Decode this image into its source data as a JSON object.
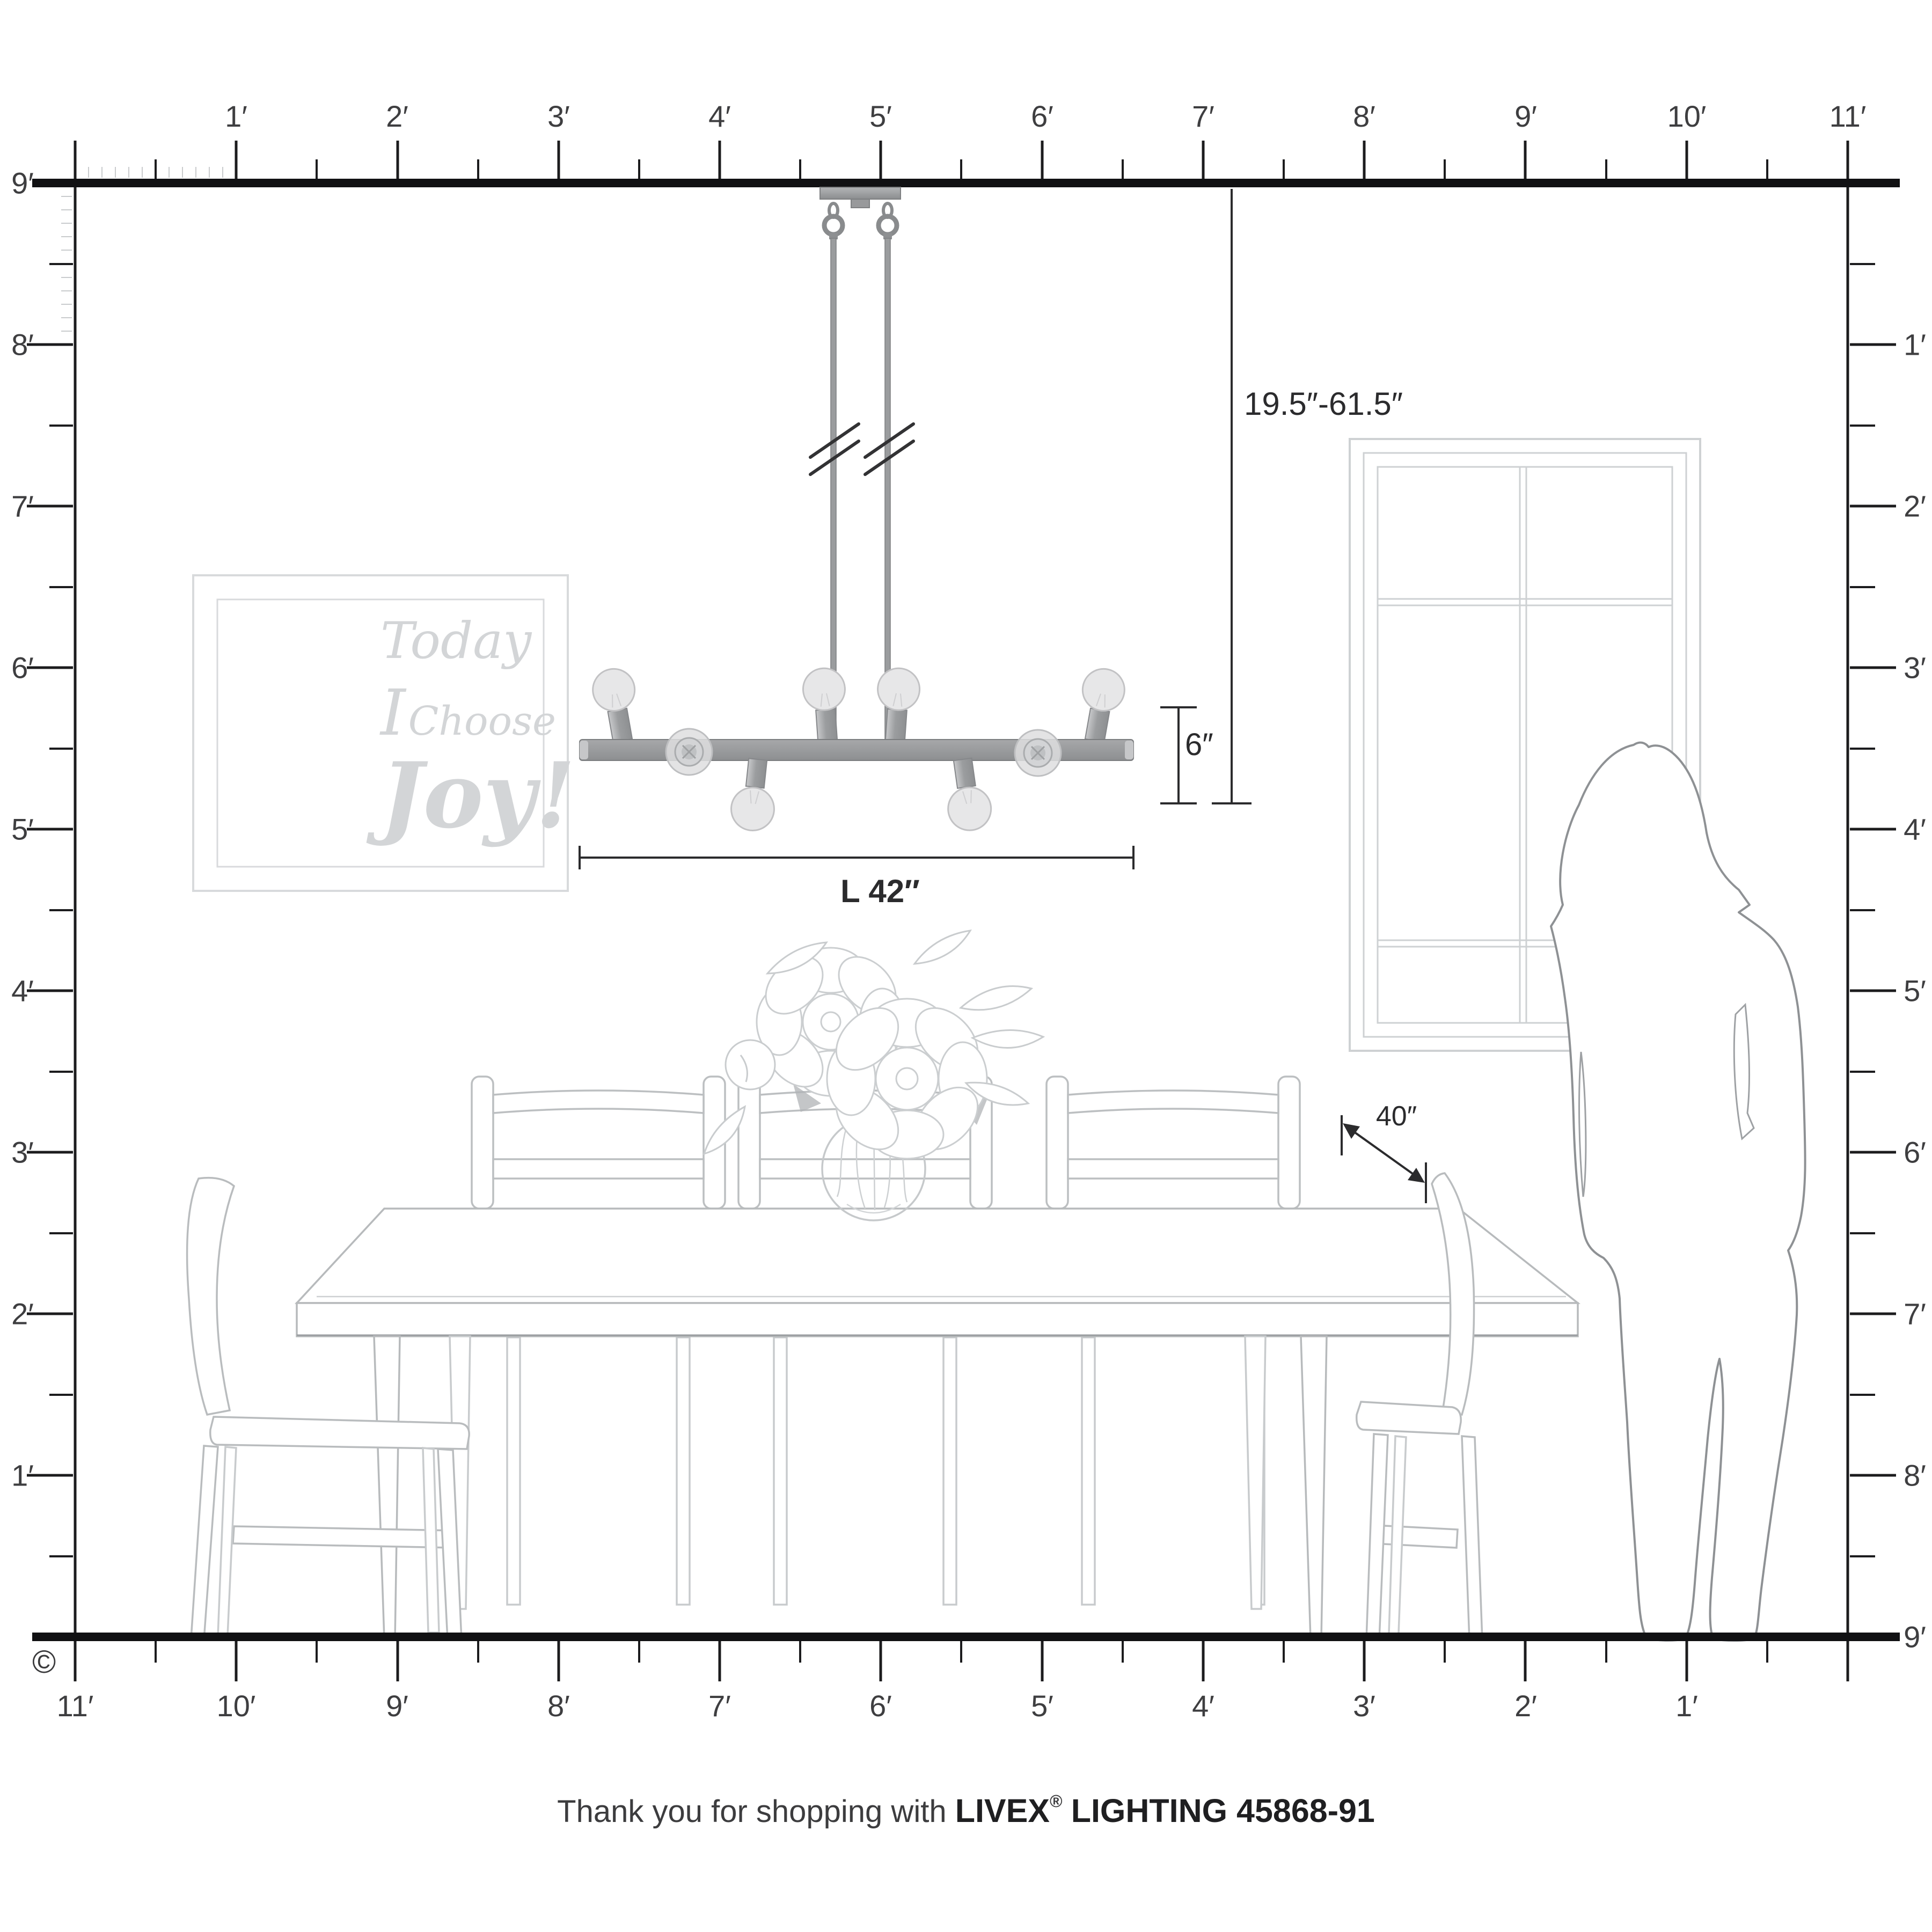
{
  "rulers": {
    "top": [
      "1′",
      "2′",
      "3′",
      "4′",
      "5′",
      "6′",
      "7′",
      "8′",
      "9′",
      "10′",
      "11′"
    ],
    "bottom": [
      "11′",
      "10′",
      "9′",
      "8′",
      "7′",
      "6′",
      "5′",
      "4′",
      "3′",
      "2′",
      "1′"
    ],
    "left": [
      "9′",
      "8′",
      "7′",
      "6′",
      "5′",
      "4′",
      "3′",
      "2′",
      "1′"
    ],
    "right": [
      "1′",
      "2′",
      "3′",
      "4′",
      "5′",
      "6′",
      "7′",
      "8′",
      "9′"
    ]
  },
  "dimensions": {
    "hang_range": "19.5″-61.5″",
    "fixture_height": "6″",
    "fixture_length": "L 42″",
    "table_depth": "40″"
  },
  "wall_art": {
    "word1": "Today",
    "word2": "I",
    "word3": "Choose",
    "word4": "Joy!"
  },
  "footer": {
    "message": "Thank you for shopping with",
    "brand": "LIVEX",
    "registered": "®",
    "product": "LIGHTING 45868-91"
  },
  "copyright_symbol": "©",
  "colors": {
    "room_line": "#1c1c1e",
    "dimension_line": "#2b2b2d",
    "furniture_gray": "#b7babc",
    "silhouette_gray": "#8e9194",
    "window_gray": "#ced1d3",
    "art_gray": "#d3d5d7",
    "metal_gray": "#9b9d9f",
    "bulb_gray": "#e7e7e8"
  }
}
